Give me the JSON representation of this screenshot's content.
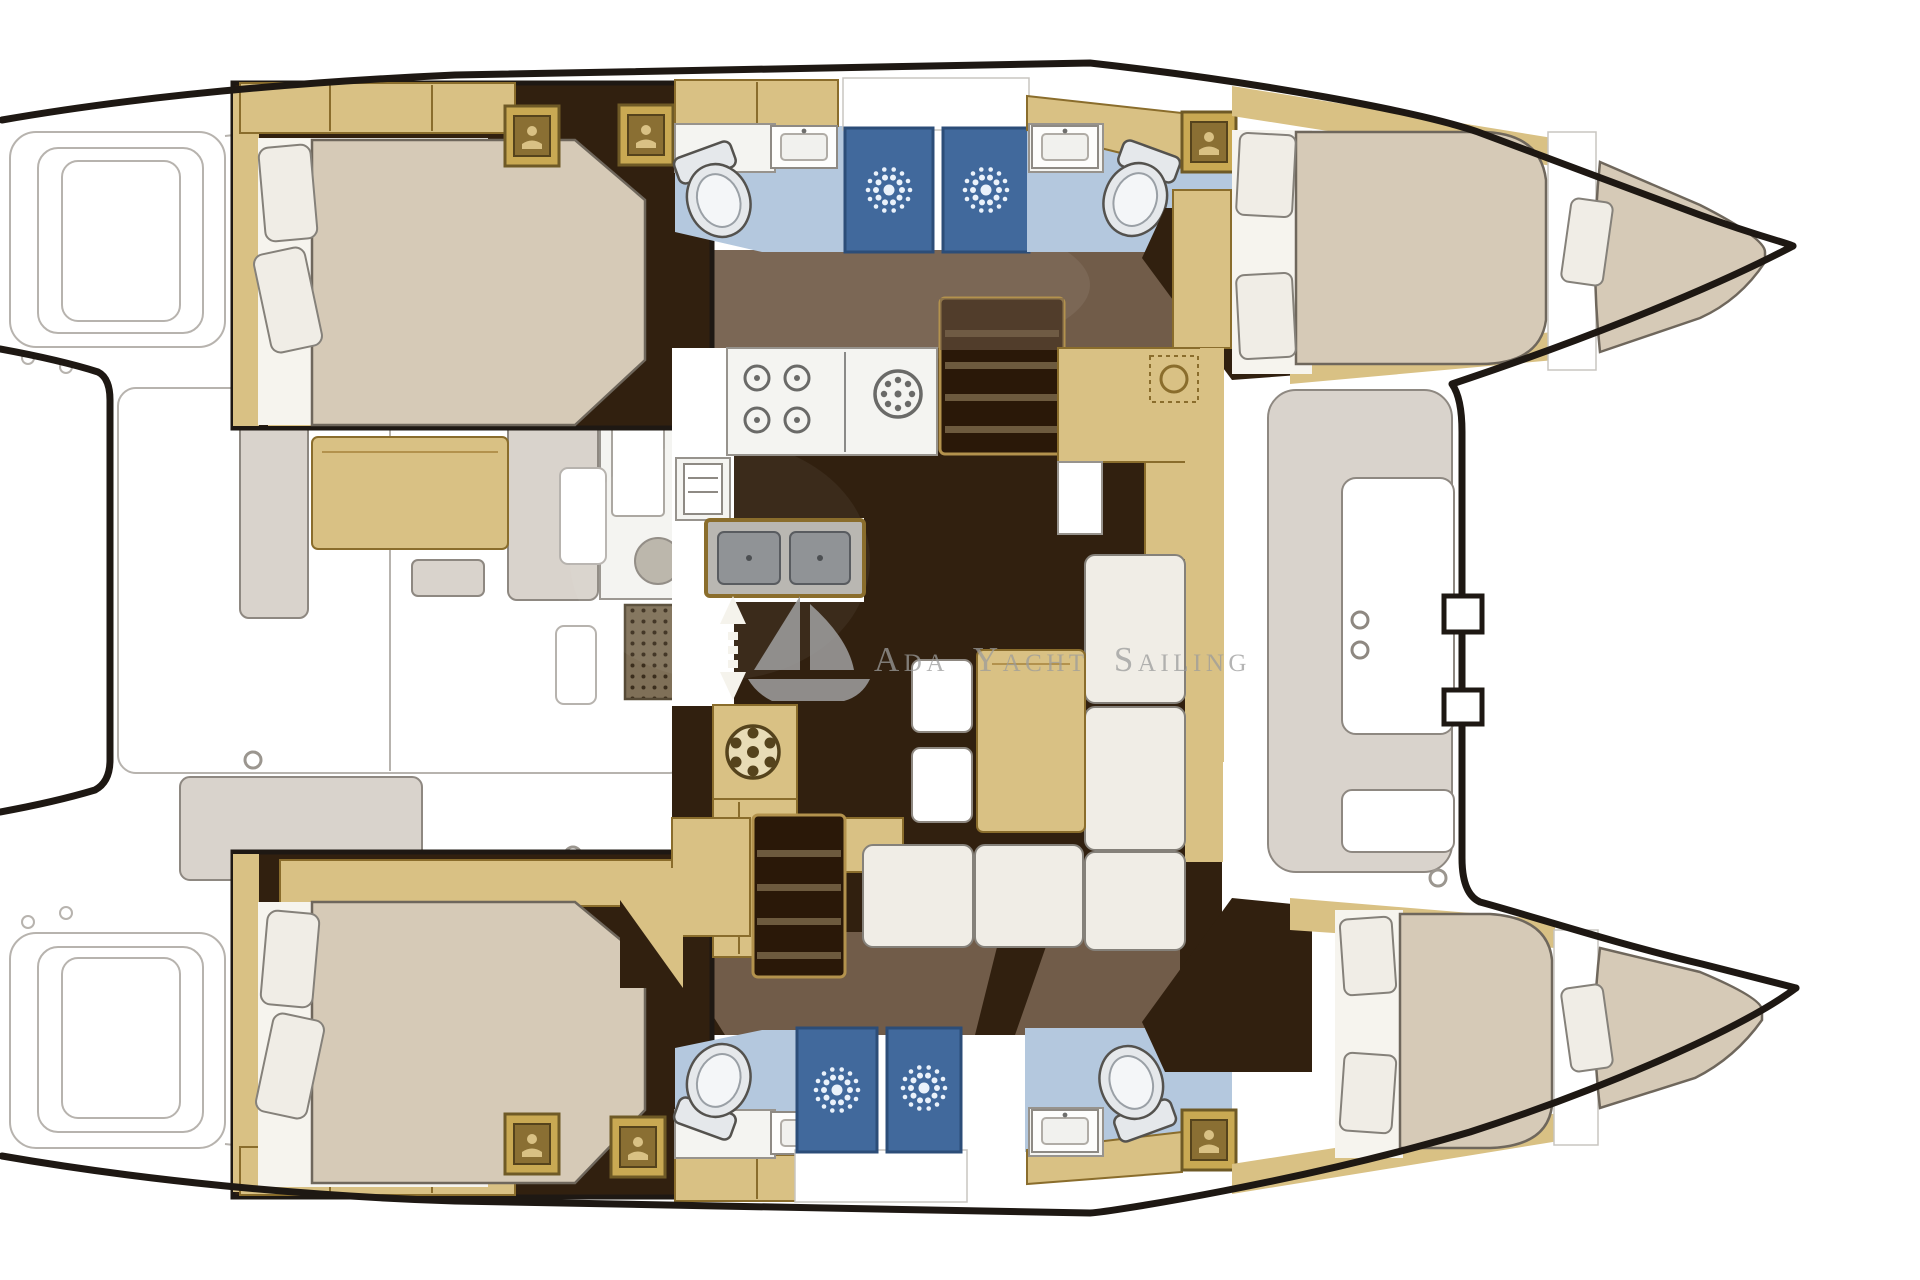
{
  "watermark": {
    "logo": "sailboat-logo",
    "text": "Ada Yacht Sailing"
  },
  "colors": {
    "outline": "#1e1813",
    "sketch": "#b7b3ae",
    "bench": "#d9d3cc",
    "bench-stroke": "#8e8881",
    "floor-dark": "#31200f",
    "floor-med": "#715c49",
    "wood": "#d9c184",
    "wood-dark": "#8a6d2c",
    "wood-deep": "#b3924d",
    "mattress": "#d6cab7",
    "mattress-stroke": "#6f675c",
    "pillow": "#f0ede6",
    "pillow-stroke": "#85817a",
    "sheet": "#f6f4ee",
    "bath-floor": "#b4c8de",
    "stall": "#41699c",
    "stall-dark": "#2c4d78",
    "burst": "#eaf2fb",
    "counter": "#f4f4f1",
    "steel": "#909396",
    "steel-dark": "#595c60",
    "toilet": "#e5e8eb",
    "step-dark": "#2a1808",
    "step-gap": "#6d5a3e",
    "watermark": "#9c9c9c",
    "grate": "#7f7058",
    "grate-dot": "#3a2d1c"
  },
  "icons": [
    "sailboat-logo",
    "toilet-icon",
    "shower-sunburst-icon",
    "sink-icon",
    "stove-burner-icon",
    "oven-fridge-icon",
    "double-sink-icon",
    "deck-hatch-icon",
    "companionway-stairs-icon",
    "up-down-arrow-icon",
    "vent-fan-icon",
    "cleat-ring-icon"
  ]
}
